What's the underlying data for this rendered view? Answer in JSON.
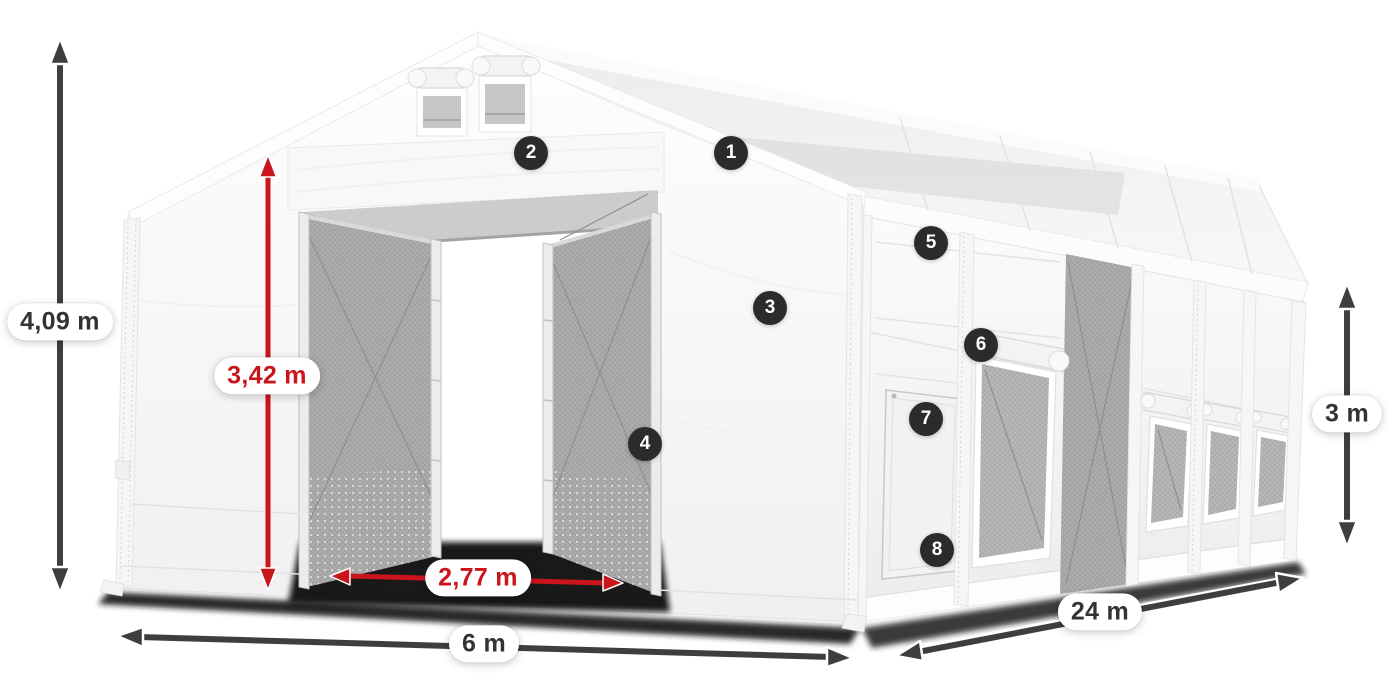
{
  "dimensions": {
    "total_height": "4,09 m",
    "entrance_height": "3,42 m",
    "entrance_width": "2,77 m",
    "width": "6 m",
    "length": "24 m",
    "side_height": "3 m"
  },
  "feature_badges": [
    {
      "label": "1"
    },
    {
      "label": "2"
    },
    {
      "label": "3"
    },
    {
      "label": "4"
    },
    {
      "label": "5"
    },
    {
      "label": "6"
    },
    {
      "label": "7"
    },
    {
      "label": "8"
    }
  ],
  "colors": {
    "arrow_dark": "#3e3e3e",
    "arrow_red": "#c9151b",
    "badge_bg": "#2b2b2b",
    "badge_text": "#ffffff",
    "label_dark": "#333333",
    "pill_bg": "#ffffff"
  }
}
